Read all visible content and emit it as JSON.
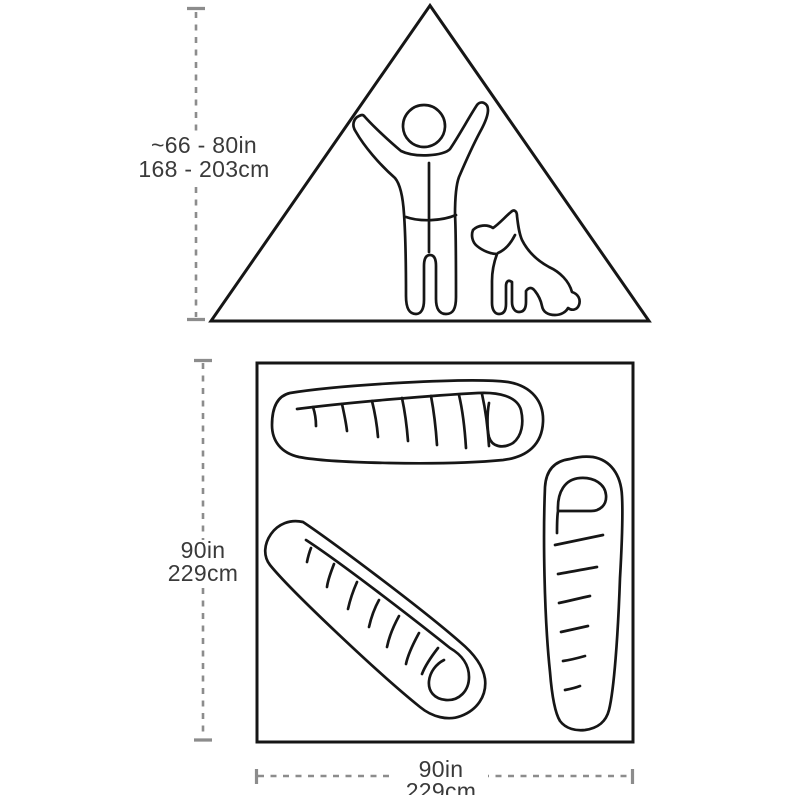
{
  "page": {
    "background": "#ffffff"
  },
  "colors": {
    "outline_ink": "#161616",
    "dimension_gray": "#8c8c8c",
    "label_text": "#3a3a3a"
  },
  "profile_view": {
    "description": "tent-side-profile-with-person-and-dog",
    "height_label": {
      "line1": "~66 - 80in",
      "line2": "168 - 203cm"
    }
  },
  "floor_plan": {
    "description": "tent-floor-plan-with-three-sleeping-bags",
    "depth_label": {
      "line1": "90in",
      "line2": "229cm"
    },
    "width_label": {
      "line1": "90in",
      "line2": "229cm"
    }
  }
}
